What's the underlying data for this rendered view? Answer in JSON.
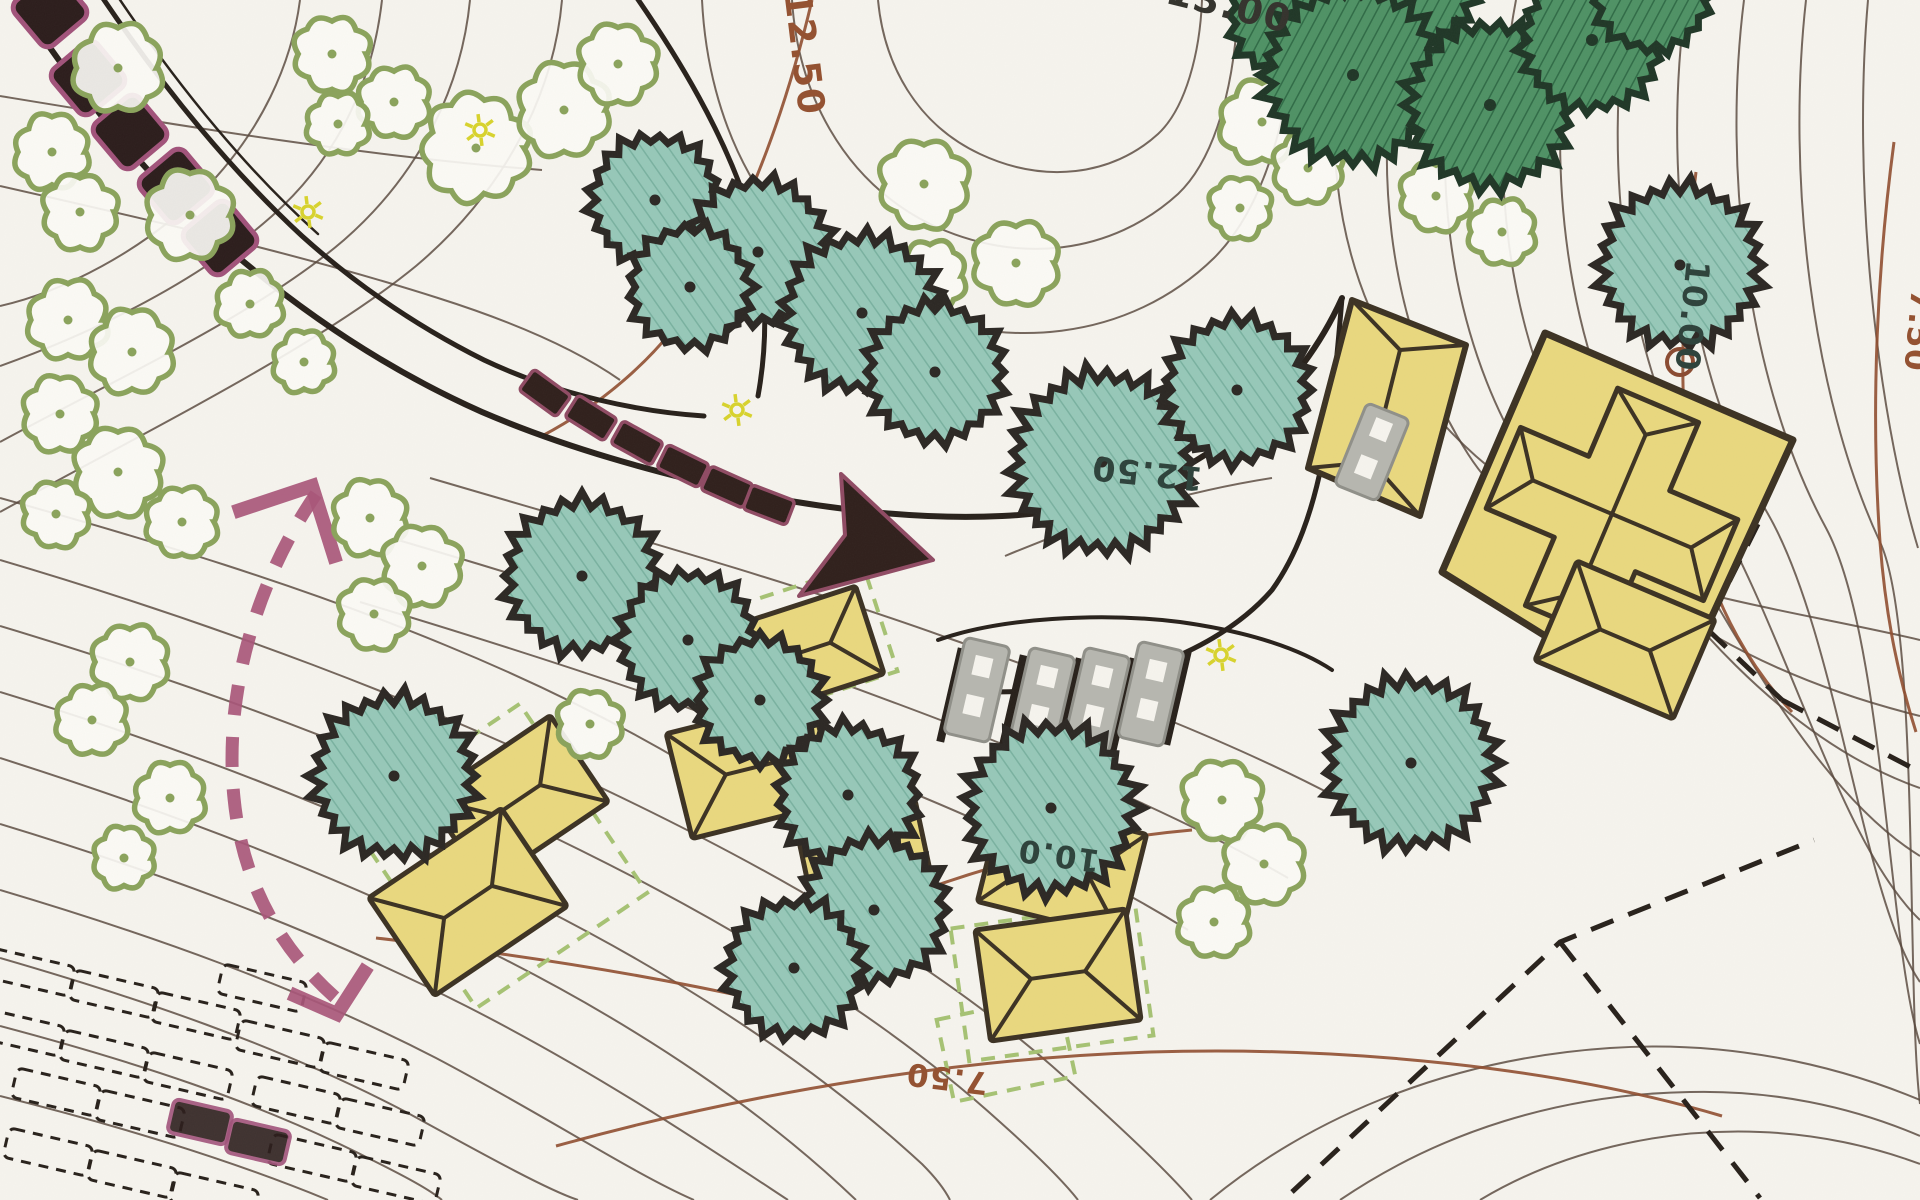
{
  "palette": {
    "paper": "#f6f4ee",
    "contour_minor": "#55463a",
    "contour_index": "#8f4c2e",
    "road_black": "#27201a",
    "tree_teal_fill": "#96c8b8",
    "tree_teal_hatch": "#79b1a0",
    "tree_teal_stroke": "#2b2723",
    "tree_dark_fill": "#4e9164",
    "tree_dark_hatch": "#2f6b46",
    "tree_dark_stroke": "#1f3626",
    "bush_olive": "#8aa35b",
    "bush_fill": "#fbfaf5",
    "building_fill": "#e9d87e",
    "building_stroke": "#3b3122",
    "stone_fill": "#2b1c1b",
    "stone_stroke": "#a1527a",
    "arrow_dark": "#2f1f1b",
    "arrow_maroon": "#8f4a63",
    "route_maroon": "#a85578",
    "bench_grey": "#b6b6af",
    "bench_grey_stroke": "#8f8f88",
    "dashed_green": "#a6c273",
    "label_brown": "#93502f",
    "label_dark": "#2c413a",
    "label_black": "#33322c",
    "sun_yellow": "#d8d32c",
    "deco_brown": "#8a4a30"
  },
  "labels": [
    {
      "text": "12.50",
      "x": 792,
      "y": 55,
      "rot": 83,
      "color": "label_brown",
      "size": 37
    },
    {
      "text": "13.00",
      "x": 1226,
      "y": 18,
      "rot": 14,
      "color": "label_black",
      "size": 38
    },
    {
      "text": "12.50",
      "x": 1148,
      "y": 462,
      "rot": 186,
      "color": "label_dark",
      "size": 33
    },
    {
      "text": "10.00",
      "x": 1681,
      "y": 315,
      "rot": 96,
      "color": "label_dark",
      "size": 33
    },
    {
      "text": "10.0",
      "x": 1060,
      "y": 845,
      "rot": 188,
      "color": "label_dark",
      "size": 31
    },
    {
      "text": "7.50",
      "x": 948,
      "y": 1068,
      "rot": 187,
      "color": "label_brown",
      "size": 31
    },
    {
      "text": "7.50",
      "x": 1908,
      "y": 330,
      "rot": 95,
      "color": "label_brown",
      "size": 31
    }
  ],
  "contours_minor": [
    "M 300,0 C 292,62 262,132 202,192 C 142,252 62,292 0,306",
    "M 382,0 C 374,72 344,152 272,216 C 200,280 96,332 0,366",
    "M 470,0 C 462,82 424,170 344,240 C 258,314 118,378 0,442",
    "M 562,0 C 554,92 506,190 416,266 C 316,348 148,430 0,512",
    "M 0,96 C 182,126 362,156 542,170",
    "M 0,186 C 150,220 300,254 438,298 C 520,324 580,352 620,380",
    "M 702,0 C 708,122 762,242 882,300 C 1002,356 1130,340 1214,258 C 1268,204 1294,100 1296,0",
    "M 792,0 C 798,92 842,180 930,224 C 1018,266 1112,254 1178,194 C 1218,156 1236,76 1238,0",
    "M 878,0 C 884,64 916,124 980,154 C 1044,184 1112,176 1158,134 C 1186,108 1200,52 1202,0",
    "M 430,478 C 600,528 780,578 948,638 C 1098,690 1228,740 1338,798",
    "M 398,540 C 568,590 738,644 898,704 C 1048,760 1178,814 1288,878",
    "M 360,602 C 520,650 680,702 830,760 C 968,813 1088,868 1188,930",
    "M 0,498 C 150,540 300,585 445,645 C 560,692 660,745 745,800",
    "M 0,560 C 210,622 420,700 610,792 C 790,878 940,968 1052,1066 C 1122,1128 1168,1172 1192,1200",
    "M 0,626 C 200,686 400,760 580,850 C 750,934 892,1024 1000,1122 C 1038,1156 1064,1182 1078,1200",
    "M 0,692 C 184,748 366,818 538,906 C 692,984 822,1072 922,1164 C 934,1176 944,1188 950,1200",
    "M 0,758 C 170,812 340,876 502,958 C 644,1030 764,1112 856,1200",
    "M 0,824 C 158,872 316,930 466,1006 C 596,1072 706,1146 788,1200",
    "M 0,890 C 148,934 296,986 436,1058 C 546,1116 634,1174 694,1200",
    "M 0,958 C 138,998 276,1044 406,1112 C 490,1158 548,1190 578,1200",
    "M 0,1026 C 128,1060 256,1100 376,1162 C 408,1178 430,1190 442,1200",
    "M 0,1096 C 112,1124 226,1158 328,1200",
    "M 1348,0 C 1322,120 1330,250 1396,360 C 1450,450 1540,520 1650,550",
    "M 1404,0 C 1370,152 1384,322 1468,454 C 1552,586 1752,600 1920,640",
    "M 1460,0 C 1428,154 1444,330 1528,464 C 1612,598 1766,678 1920,716",
    "M 1516,0 C 1486,158 1504,340 1588,476 C 1672,612 1788,742 1920,788",
    "M 1572,0 C 1544,162 1564,350 1648,488 C 1726,616 1812,790 1920,856",
    "M 1628,0 C 1602,166 1624,360 1708,500 C 1786,630 1840,844 1920,920",
    "M 1686,0 C 1662,170 1686,372 1768,514 C 1838,636 1862,898 1920,982",
    "M 1744,0 C 1722,174 1748,384 1826,528 C 1884,636 1888,944 1920,1044",
    "M 1806,0 C 1786,178 1812,396 1880,542 C 1920,628 1906,992 1920,1104",
    "M 1868,0 C 1852,182 1876,408 1918,548",
    "M 1210,1200 C 1320,1110 1460,1058 1610,1048 C 1726,1040 1834,1064 1920,1100",
    "M 1340,1200 C 1440,1132 1560,1094 1690,1092 C 1772,1090 1850,1106 1920,1136",
    "M 1480,1200 C 1560,1152 1660,1128 1760,1132 C 1816,1134 1872,1146 1920,1164",
    "M 1005,556 C 1090,520 1182,492 1272,478"
  ],
  "contours_index": [
    "M 812,0 C 788,102 752,204 702,288 C 664,352 606,402 542,436",
    "M 1894,142 C 1878,262 1870,402 1880,542 C 1886,622 1900,682 1916,732",
    "M 556,1146 C 758,1090 968,1058 1150,1052 C 1350,1046 1560,1068 1722,1116",
    "M 1696,172 C 1682,282 1678,392 1690,492 C 1700,572 1736,652 1792,712",
    "M 376,938 C 518,954 642,974 760,1000",
    "M 918,892 C 1010,858 1102,838 1192,830"
  ],
  "roads": [
    {
      "d": "M 10,-12 C 62,70 132,162 216,238 C 302,314 392,372 482,412 C 566,448 654,472 742,492 C 830,510 922,520 1002,516 C 1100,512 1182,478 1242,428 C 1292,386 1322,342 1342,298",
      "w": 6
    },
    {
      "d": "M 96,-12 C 152,72 222,162 302,236 C 362,290 424,330 484,360 C 560,396 642,412 704,416",
      "w": 5
    },
    {
      "d": "M 630,-12 C 682,62 722,132 746,202 C 766,262 770,330 758,396",
      "w": 5
    },
    {
      "d": "M 112,-12 C 168,72 238,162 318,234",
      "w": 2.5
    },
    {
      "d": "M 1342,298 C 1332,418 1322,520 1272,590 C 1202,670 1062,700 962,690",
      "w": 5
    },
    {
      "d": "M 938,640 C 1000,618 1100,612 1180,622 C 1252,632 1302,650 1332,670",
      "w": 4
    }
  ],
  "dashed_black": [
    "M 1292,1192 L 1560,942 L 1814,840",
    "M 1560,942 L 1760,1198",
    "M 1758,524 L 1706,628 L 1782,700",
    "M 1782,700 L 1920,772"
  ],
  "teal_trees": [
    {
      "cx": 655,
      "cy": 200,
      "r": 66
    },
    {
      "cx": 758,
      "cy": 252,
      "r": 74
    },
    {
      "cx": 690,
      "cy": 287,
      "r": 62
    },
    {
      "cx": 862,
      "cy": 313,
      "r": 80
    },
    {
      "cx": 935,
      "cy": 372,
      "r": 70
    },
    {
      "cx": 1102,
      "cy": 462,
      "r": 92
    },
    {
      "cx": 1237,
      "cy": 390,
      "r": 74
    },
    {
      "cx": 582,
      "cy": 576,
      "r": 78
    },
    {
      "cx": 688,
      "cy": 640,
      "r": 70
    },
    {
      "cx": 760,
      "cy": 700,
      "r": 64
    },
    {
      "cx": 394,
      "cy": 776,
      "r": 82
    },
    {
      "cx": 848,
      "cy": 795,
      "r": 72
    },
    {
      "cx": 874,
      "cy": 910,
      "r": 74
    },
    {
      "cx": 794,
      "cy": 968,
      "r": 70
    },
    {
      "cx": 1051,
      "cy": 808,
      "r": 86
    },
    {
      "cx": 1411,
      "cy": 763,
      "r": 86
    },
    {
      "cx": 1680,
      "cy": 265,
      "r": 82
    }
  ],
  "dark_trees": [
    {
      "cx": 1292,
      "cy": 15,
      "r": 64
    },
    {
      "cx": 1408,
      "cy": -20,
      "r": 70
    },
    {
      "cx": 1353,
      "cy": 75,
      "r": 90
    },
    {
      "cx": 1490,
      "cy": 105,
      "r": 84
    },
    {
      "cx": 1592,
      "cy": 40,
      "r": 72
    },
    {
      "cx": 1652,
      "cy": -8,
      "r": 60
    }
  ],
  "bushes": [
    {
      "cx": 118,
      "cy": 68,
      "r": 40
    },
    {
      "cx": 52,
      "cy": 152,
      "r": 34
    },
    {
      "cx": 190,
      "cy": 215,
      "r": 40
    },
    {
      "cx": 80,
      "cy": 212,
      "r": 34
    },
    {
      "cx": 332,
      "cy": 54,
      "r": 34
    },
    {
      "cx": 394,
      "cy": 102,
      "r": 32
    },
    {
      "cx": 338,
      "cy": 124,
      "r": 28
    },
    {
      "cx": 476,
      "cy": 148,
      "r": 48
    },
    {
      "cx": 564,
      "cy": 110,
      "r": 42
    },
    {
      "cx": 618,
      "cy": 64,
      "r": 36
    },
    {
      "cx": 924,
      "cy": 184,
      "r": 40
    },
    {
      "cx": 1016,
      "cy": 263,
      "r": 38
    },
    {
      "cx": 930,
      "cy": 276,
      "r": 32
    },
    {
      "cx": 1262,
      "cy": 122,
      "r": 38
    },
    {
      "cx": 1344,
      "cy": 90,
      "r": 34
    },
    {
      "cx": 1308,
      "cy": 168,
      "r": 32
    },
    {
      "cx": 1240,
      "cy": 208,
      "r": 28
    },
    {
      "cx": 1436,
      "cy": 196,
      "r": 32
    },
    {
      "cx": 1502,
      "cy": 232,
      "r": 30
    },
    {
      "cx": 68,
      "cy": 320,
      "r": 36
    },
    {
      "cx": 132,
      "cy": 352,
      "r": 38
    },
    {
      "cx": 60,
      "cy": 414,
      "r": 34
    },
    {
      "cx": 118,
      "cy": 472,
      "r": 40
    },
    {
      "cx": 56,
      "cy": 514,
      "r": 30
    },
    {
      "cx": 182,
      "cy": 522,
      "r": 32
    },
    {
      "cx": 250,
      "cy": 304,
      "r": 30
    },
    {
      "cx": 304,
      "cy": 362,
      "r": 28
    },
    {
      "cx": 370,
      "cy": 518,
      "r": 34
    },
    {
      "cx": 422,
      "cy": 566,
      "r": 36
    },
    {
      "cx": 374,
      "cy": 614,
      "r": 32
    },
    {
      "cx": 130,
      "cy": 662,
      "r": 34
    },
    {
      "cx": 92,
      "cy": 720,
      "r": 32
    },
    {
      "cx": 170,
      "cy": 798,
      "r": 32
    },
    {
      "cx": 124,
      "cy": 858,
      "r": 28
    },
    {
      "cx": 590,
      "cy": 724,
      "r": 30
    },
    {
      "cx": 1222,
      "cy": 800,
      "r": 36
    },
    {
      "cx": 1264,
      "cy": 864,
      "r": 36
    },
    {
      "cx": 1214,
      "cy": 922,
      "r": 32
    }
  ],
  "main_house": {
    "pad_polygon": [
      [
        1545,
        333
      ],
      [
        1793,
        440
      ],
      [
        1668,
        712
      ],
      [
        1442,
        572
      ]
    ],
    "annex_polygon": [
      [
        1352,
        300
      ],
      [
        1466,
        345
      ],
      [
        1420,
        516
      ],
      [
        1308,
        468
      ]
    ],
    "annex_roof_lines": [
      [
        1352,
        300,
        1400,
        350
      ],
      [
        1466,
        345,
        1400,
        350
      ],
      [
        1420,
        516,
        1372,
        462
      ],
      [
        1308,
        468,
        1372,
        462
      ],
      [
        1400,
        350,
        1372,
        462
      ]
    ],
    "cross": {
      "cx": 1612,
      "cy": 514,
      "rot": 23,
      "arm_half": 118,
      "width_half": 44,
      "ridge_inset": 32
    },
    "porch": {
      "cx": 1625,
      "cy": 640,
      "w": 150,
      "h": 108,
      "rot": 23
    },
    "bench": {
      "cx": 1372,
      "cy": 452,
      "w": 46,
      "h": 88,
      "rot": 22
    },
    "deco_circle": {
      "cx": 1680,
      "cy": 362,
      "r": 13
    }
  },
  "huts": [
    {
      "cx": 808,
      "cy": 650,
      "w": 130,
      "h": 92,
      "rot": -18
    },
    {
      "cx": 752,
      "cy": 768,
      "w": 150,
      "h": 108,
      "rot": -14
    },
    {
      "cx": 865,
      "cy": 858,
      "w": 122,
      "h": 92,
      "rot": -12
    },
    {
      "cx": 1062,
      "cy": 868,
      "w": 148,
      "h": 106,
      "rot": 14
    },
    {
      "cx": 1058,
      "cy": 975,
      "w": 152,
      "h": 112,
      "rot": -8
    },
    {
      "cx": 518,
      "cy": 800,
      "w": 148,
      "h": 104,
      "rot": -34
    },
    {
      "cx": 468,
      "cy": 902,
      "w": 160,
      "h": 118,
      "rot": -34
    }
  ],
  "green_dashed_rects": [
    {
      "cx": 806,
      "cy": 642,
      "w": 156,
      "h": 112,
      "rot": -18
    },
    {
      "cx": 1052,
      "cy": 982,
      "w": 186,
      "h": 134,
      "rot": -8
    },
    {
      "cx": 498,
      "cy": 856,
      "w": 206,
      "h": 228,
      "rot": -34
    },
    {
      "cx": 1006,
      "cy": 1048,
      "w": 124,
      "h": 84,
      "rot": -12
    }
  ],
  "stones": [
    {
      "cx": 50,
      "cy": 10
    },
    {
      "cx": 88,
      "cy": 78
    },
    {
      "cx": 130,
      "cy": 132
    },
    {
      "cx": 176,
      "cy": 186
    },
    {
      "cx": 220,
      "cy": 238
    }
  ],
  "stone_style": {
    "size": 58,
    "rot": -40
  },
  "big_arrow": {
    "segments": [
      {
        "cx": 545,
        "cy": 393,
        "rot": 36
      },
      {
        "cx": 591,
        "cy": 418,
        "rot": 32
      },
      {
        "cx": 637,
        "cy": 443,
        "rot": 29
      },
      {
        "cx": 683,
        "cy": 466,
        "rot": 26
      },
      {
        "cx": 727,
        "cy": 487,
        "rot": 24
      },
      {
        "cx": 769,
        "cy": 505,
        "rot": 21
      }
    ],
    "seg_w": 46,
    "seg_h": 26,
    "head_polygon": [
      [
        933,
        560
      ],
      [
        799,
        596
      ],
      [
        845,
        535
      ],
      [
        841,
        474
      ]
    ]
  },
  "route_arrow": {
    "shaft": "M 316,494 C 252,588 224,700 234,798 C 242,880 278,948 338,1000",
    "head_top": "M 240,510 L 312,486 L 334,556",
    "head_bottom": "M 296,996 L 337,1014 L 364,972"
  },
  "benches": {
    "row": [
      {
        "cx": 977,
        "cy": 690
      },
      {
        "cx": 1042,
        "cy": 700
      },
      {
        "cx": 1097,
        "cy": 700
      },
      {
        "cx": 1151,
        "cy": 694
      }
    ],
    "w": 46,
    "h": 98,
    "rot": 13,
    "bars": [
      {
        "cx": 951,
        "cy": 695
      },
      {
        "cx": 1013,
        "cy": 702
      },
      {
        "cx": 1069,
        "cy": 705
      },
      {
        "cx": 1123,
        "cy": 705
      },
      {
        "cx": 1177,
        "cy": 698
      }
    ]
  },
  "parking": {
    "w": 86,
    "h": 30,
    "rot": 13,
    "stalls": [
      {
        "cx": 30,
        "cy": 972
      },
      {
        "cx": 114,
        "cy": 994
      },
      {
        "cx": 196,
        "cy": 1016
      },
      {
        "cx": 20,
        "cy": 1032
      },
      {
        "cx": 104,
        "cy": 1054
      },
      {
        "cx": 188,
        "cy": 1076
      },
      {
        "cx": 56,
        "cy": 1092
      },
      {
        "cx": 140,
        "cy": 1114
      },
      {
        "cx": 48,
        "cy": 1152
      },
      {
        "cx": 132,
        "cy": 1174
      },
      {
        "cx": 214,
        "cy": 1196
      },
      {
        "cx": 262,
        "cy": 988
      },
      {
        "cx": 280,
        "cy": 1044
      },
      {
        "cx": 364,
        "cy": 1066
      },
      {
        "cx": 296,
        "cy": 1100
      },
      {
        "cx": 380,
        "cy": 1122
      },
      {
        "cx": 312,
        "cy": 1158
      },
      {
        "cx": 396,
        "cy": 1180
      }
    ],
    "filled_stalls": [
      {
        "cx": 200,
        "cy": 1122
      },
      {
        "cx": 258,
        "cy": 1142
      }
    ]
  },
  "suns": [
    {
      "cx": 480,
      "cy": 130
    },
    {
      "cx": 308,
      "cy": 212
    },
    {
      "cx": 737,
      "cy": 410
    },
    {
      "cx": 1221,
      "cy": 655
    }
  ]
}
